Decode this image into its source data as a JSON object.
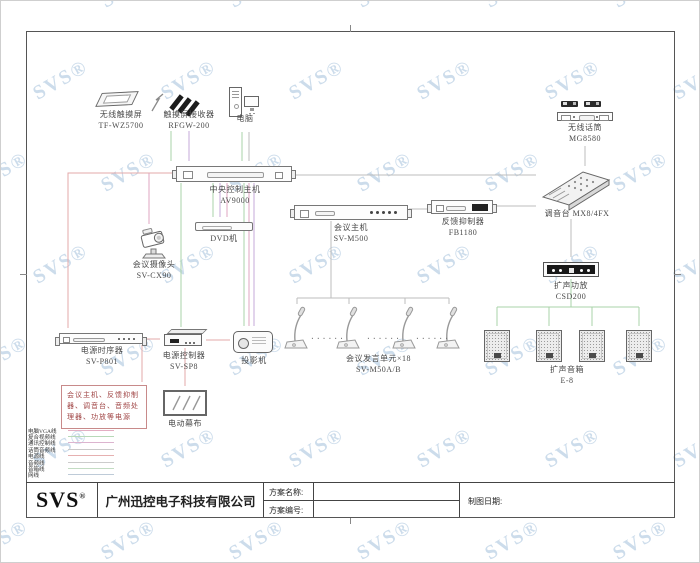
{
  "watermark": {
    "text": "SVS®",
    "color": "rgba(128,168,204,0.40)"
  },
  "nodes": {
    "touchscreen": {
      "name": "无线触摸屏",
      "model": "TF-WZ5700"
    },
    "ts_receiver": {
      "name": "触摸屏接收器",
      "model": "RFGW-200"
    },
    "computer": {
      "name": "电脑"
    },
    "central_host": {
      "name": "中央控制主机",
      "model": "AV9000"
    },
    "dvd": {
      "name": "DVD机"
    },
    "camera": {
      "name": "会议摄像头",
      "model": "SV-CX90"
    },
    "conference_host": {
      "name": "会议主机",
      "model": "SV-M500"
    },
    "feedback_suppressor": {
      "name": "反馈抑制器",
      "model": "FB1180"
    },
    "wireless_mic": {
      "name": "无线话筒",
      "model": "MG8580"
    },
    "mixer": {
      "name": "调音台 MX8/4FX"
    },
    "amplifier": {
      "name": "扩声功放",
      "model": "CSD200"
    },
    "speakers": {
      "name": "扩声音箱",
      "model": "E-8"
    },
    "power_sequencer": {
      "name": "电源时序器",
      "model": "SV-P801"
    },
    "power_controller": {
      "name": "电源控制器",
      "model": "SV-SP8"
    },
    "projector": {
      "name": "投影机"
    },
    "motor_screen": {
      "name": "电动幕布"
    },
    "conference_units": {
      "name": "会议发言单元×18",
      "model": "SV-M50A/B"
    },
    "power_note": "会议主机、反馈抑制器、调音台、音频处理器、功放等电源",
    "unit_dots": "......"
  },
  "legend": {
    "items": [
      {
        "label": "电脑VGA线",
        "color": "#e3aec3"
      },
      {
        "label": "复合视频线",
        "color": "#b7d9b7"
      },
      {
        "label": "通讯控制线",
        "color": "#dcb4cf"
      },
      {
        "label": "话筒音频线",
        "color": "#c9c9c9"
      },
      {
        "label": "电源线",
        "color": "#e6b0b0"
      },
      {
        "label": "音频线",
        "color": "#cccccc"
      },
      {
        "label": "音箱线",
        "color": "#c3dcc3"
      },
      {
        "label": "网线",
        "color": "#becbd8"
      }
    ]
  },
  "line_colors": {
    "vga": "#dfa6c0",
    "video": "#a9d3a9",
    "control": "#c4a9da",
    "audio": "#bdbdbd",
    "power": "#e3a9a9"
  },
  "title_block": {
    "logo": "SVS",
    "logo_reg": "®",
    "company": "广州迅控电子科技有限公司",
    "scheme_name_label": "方案名称:",
    "scheme_no_label": "方案编号:",
    "date_label": "制图日期:",
    "scheme_name_value": "",
    "scheme_no_value": "",
    "date_value": ""
  }
}
